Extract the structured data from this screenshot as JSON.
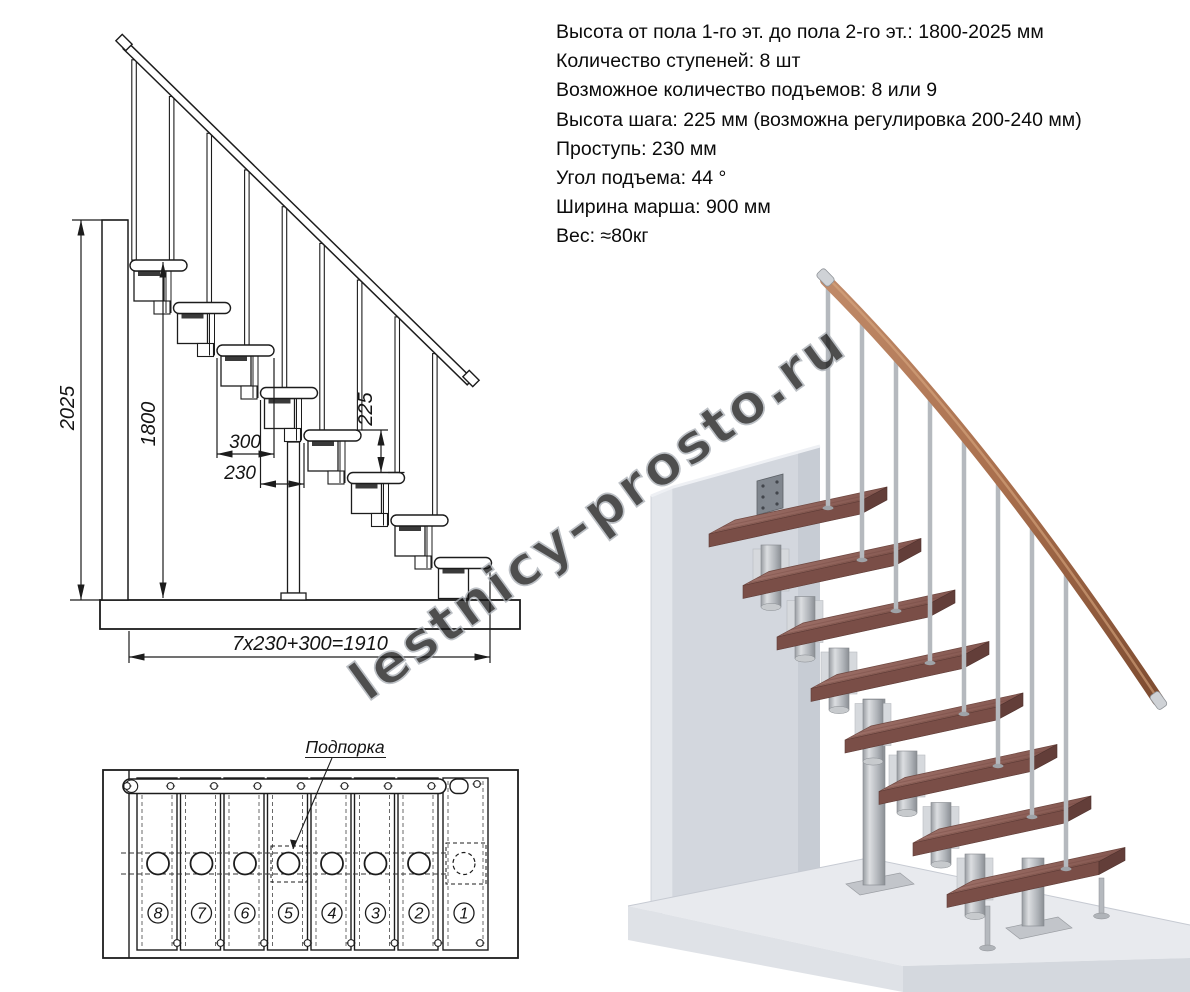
{
  "specs": {
    "lines": [
      "Высота от пола 1-го эт. до пола 2-го эт.: 1800-2025 мм",
      "Количество ступеней: 8 шт",
      "Возможное количество подъемов: 8 или 9",
      "Высота шага: 225 мм (возможна регулировка 200-240 мм)",
      "Проступь: 230 мм",
      "Угол подъема: 44 °",
      "Ширина марша: 900 мм",
      "Вес: ≈80кг"
    ]
  },
  "side_view": {
    "dim_total_height": "2025",
    "dim_flight_height": "1800",
    "dim_tread_width": "300",
    "dim_run": "230",
    "dim_rise": "225",
    "dim_total_run": "7x230+300=1910"
  },
  "plan_view": {
    "support_label": "Подпорка",
    "step_numbers": [
      "8",
      "7",
      "6",
      "5",
      "4",
      "3",
      "2",
      "1"
    ]
  },
  "watermark": {
    "text": "lestnicy-prosto.ru"
  },
  "colors": {
    "drawing_line": "#1c1c1c",
    "tread_wood_top": "#94675f",
    "tread_wood_front": "#7a4e47",
    "tread_wood_side": "#633e39",
    "handrail_wood": "#a97150",
    "metal": "#b5b9be",
    "wall_gray": "#d3d7de",
    "floor_gray": "#e8eaee",
    "watermark_gray": "#a8adb3"
  }
}
